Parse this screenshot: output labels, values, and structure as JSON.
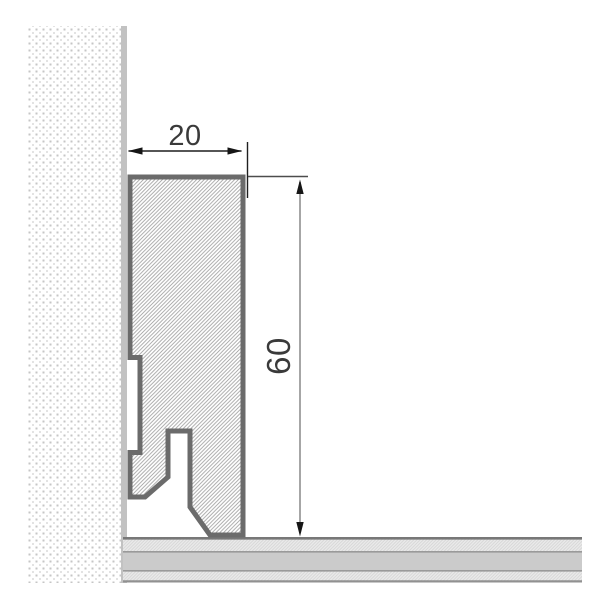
{
  "diagram": {
    "type": "technical-drawing",
    "subject": "Skirting board profile cross-section mounted on wall above floor",
    "dimensions": {
      "width_label": "20",
      "height_label": "60"
    },
    "colors": {
      "profile_outline": "#6b6b6b",
      "profile_hatch_line": "#a3a3a3",
      "wall_dot": "#c6c6c6",
      "wall_edge": "#c2c2c2",
      "floor_surface": "#eaeaea",
      "floor_core": "#cbcbcb",
      "dimension_primary": "#1f1f1f",
      "dimension_secondary": "#9c9c9c",
      "label_text": "#3a3a3a"
    }
  }
}
